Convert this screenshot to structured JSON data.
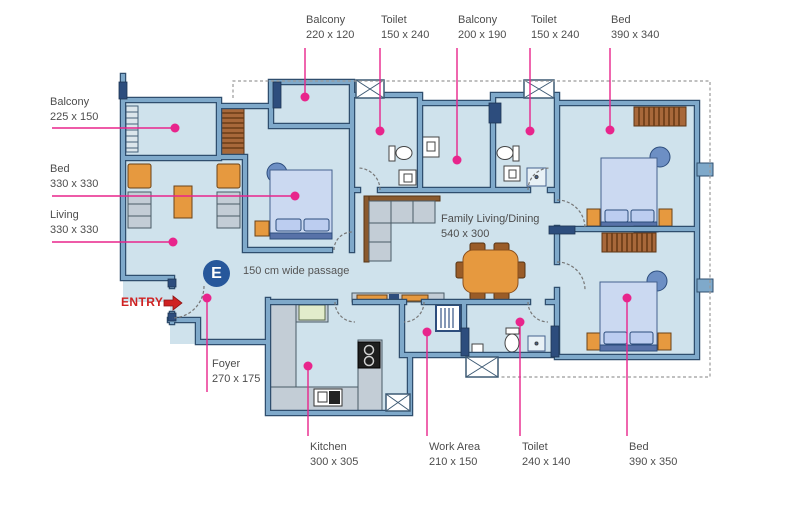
{
  "labels": {
    "top": [
      {
        "name": "Balcony",
        "dim": "220 x 120"
      },
      {
        "name": "Toilet",
        "dim": "150 x 240"
      },
      {
        "name": "Balcony",
        "dim": "200 x 190"
      },
      {
        "name": "Toilet",
        "dim": "150 x 240"
      },
      {
        "name": "Bed",
        "dim": "390 x 340"
      }
    ],
    "left": [
      {
        "name": "Balcony",
        "dim": "225 x 150"
      },
      {
        "name": "Bed",
        "dim": "330 x 330"
      },
      {
        "name": "Living",
        "dim": "330 x 330"
      }
    ],
    "bottom": [
      {
        "name": "Kitchen",
        "dim": "300 x 305"
      },
      {
        "name": "Work Area",
        "dim": "210 x 150"
      },
      {
        "name": "Toilet",
        "dim": "240 x 140"
      },
      {
        "name": "Bed",
        "dim": "390 x 350"
      }
    ],
    "foyer": {
      "name": "Foyer",
      "dim": "270 x 175"
    },
    "family": {
      "name": "Family Living/Dining",
      "dim": "540 x 300"
    },
    "passage": "150 cm wide passage",
    "entry": "ENTRY",
    "badge": "E"
  },
  "colors": {
    "floor": "#cfe2ec",
    "wall": "#7fa9ca",
    "wall_outline": "#2f4e6e",
    "wall_dark": "#2d4d7d",
    "leader_pink": "#e8258c",
    "entry_red": "#cf2222",
    "badge_blue": "#27579b",
    "label_text": "#4d4d4d",
    "furniture_orange": "#e6993f",
    "wood_brown": "#a8683a",
    "bed_blue": "#cbd9f1",
    "counter_gray": "#c3cdd6",
    "sink_green": "#e2eccb"
  }
}
